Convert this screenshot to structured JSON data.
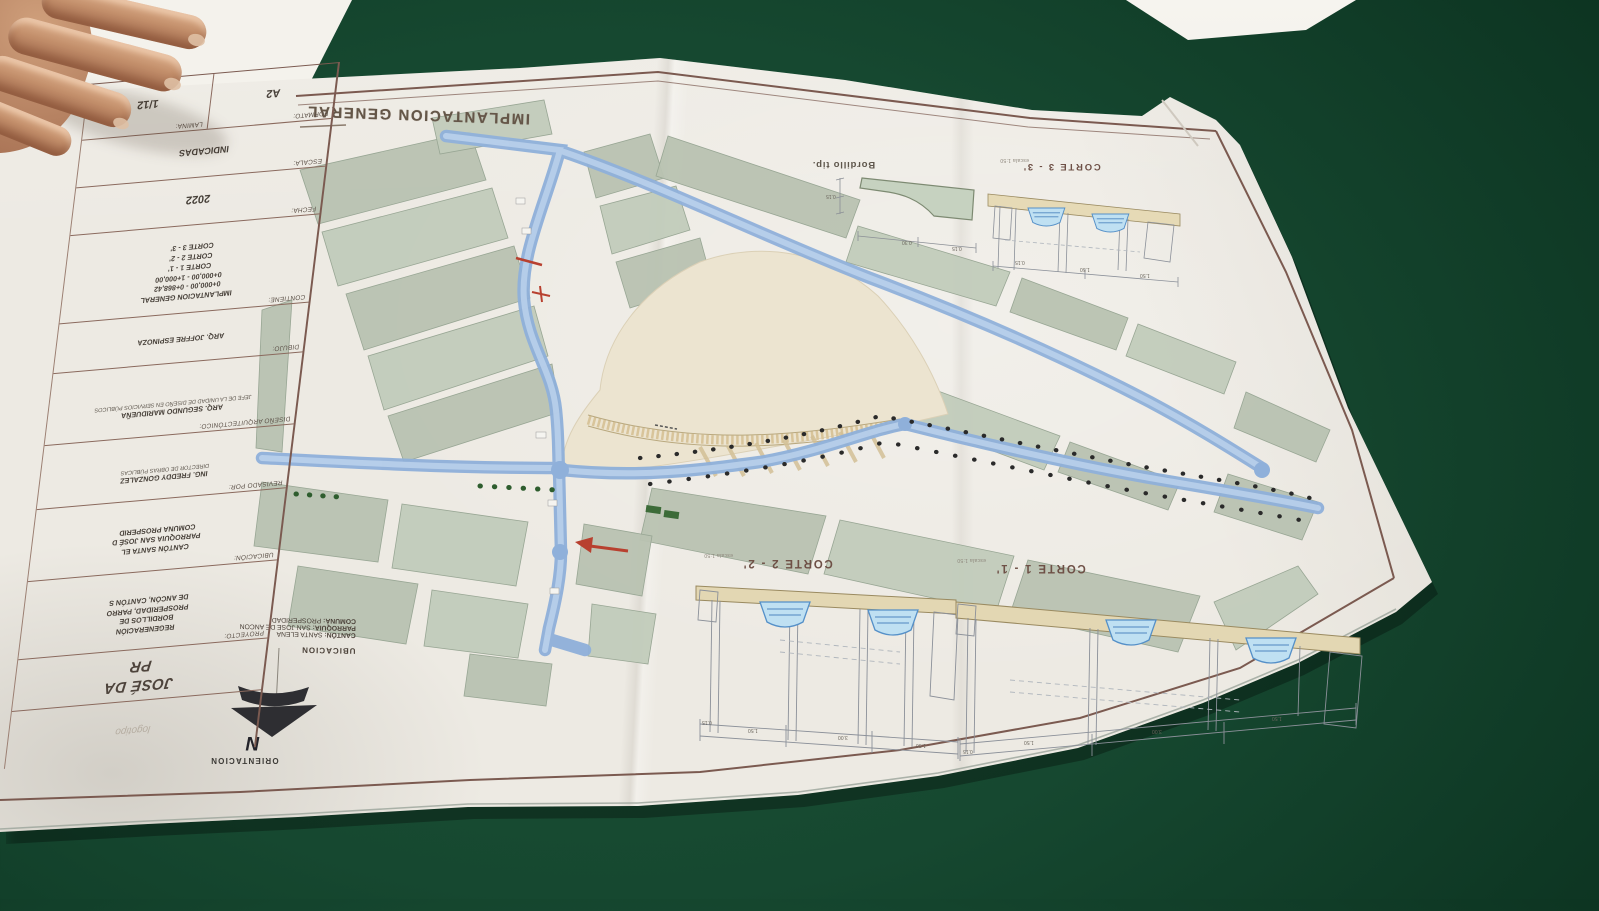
{
  "plan": {
    "title": "IMPLANTACION GENERAL",
    "north_label": "ORIENTACION",
    "north_letter": "N",
    "ubicacion_title": "UBICACION",
    "ubi1_label": "CANTÓN:",
    "ubi1": "SANTA ELENA",
    "ubi2_label": "PARROQUIA:",
    "ubi2": "SAN JOSE DE ANCON",
    "ubi3_label": "COMUNA:",
    "ubi3": "PROSPERIDAD"
  },
  "sections": {
    "s33": "CORTE 3 - 3'",
    "s22": "CORTE 2 - 2'",
    "s11": "CORTE 1 - 1'",
    "scale": "escala 1:50",
    "detail": "Bordillo tip."
  },
  "dims": {
    "a": "0.15",
    "b": "1.50",
    "c": "3.00",
    "d": "0.30"
  },
  "tb": {
    "formato_label": "FORMATO:",
    "formato": "A2",
    "lamina_label": "LAMINA:",
    "lamina": "1/12",
    "escala_label": "ESCALA:",
    "escala": "INDICADAS",
    "fecha_label": "FECHA:",
    "fecha": "2022",
    "contiene_label": "CONTIENE:",
    "contiene1": "IMPLANTACION GENERAL",
    "contiene2": "0+000,00 - 0+868,42",
    "contiene3": "0+000,00 - 1+000,00",
    "contiene4": "CORTE 1 - 1'",
    "contiene5": "CORTE 2 - 2'",
    "contiene6": "CORTE 3 - 3'",
    "dibujo_label": "DIBUJO:",
    "dibujo": "ARQ. JOFFRE ESPINOZA",
    "diseno_label": "DISEÑO ARQUITECTÓNICO:",
    "diseno": "ARQ. SEGUNDO MARIDUEÑA",
    "diseno_nota": "JEFE DE LA UNIDAD DE DISEÑO EN SERVICIOS PÚBLICOS",
    "revisado_label": "REVISADO POR:",
    "revisado": "ING. FREDDY GONZALEZ",
    "revisado_nota": "DIRECTOR DE OBRAS PÚBLICAS",
    "ubicacion_label": "UBICACIÓN:",
    "ubicacion1": "CANTÓN SANTA EL",
    "ubicacion2": "PARROQUIA SAN JOSÉ D",
    "ubicacion3": "COMUNA PROSPERID",
    "proyecto_label": "PROYECTO:",
    "proyecto1": "REGENERACIÓN",
    "proyecto2": "BORDILLOS DE",
    "proyecto3": "PROSPERIDAD, PARRO",
    "proyecto4": "DE ANCÓN, CANTÓN S",
    "big1": "JOSÉ DA",
    "big2": "PR",
    "logo": "logotipo"
  },
  "colors": {
    "table_green": "#164830",
    "paper": "#edeae3",
    "frame_brown": "#7b5a50",
    "road_blue": "#8fb0da",
    "block_green": "#b8c2b1",
    "band_tan": "#e3d7b3",
    "marker_red": "#b8402f"
  }
}
